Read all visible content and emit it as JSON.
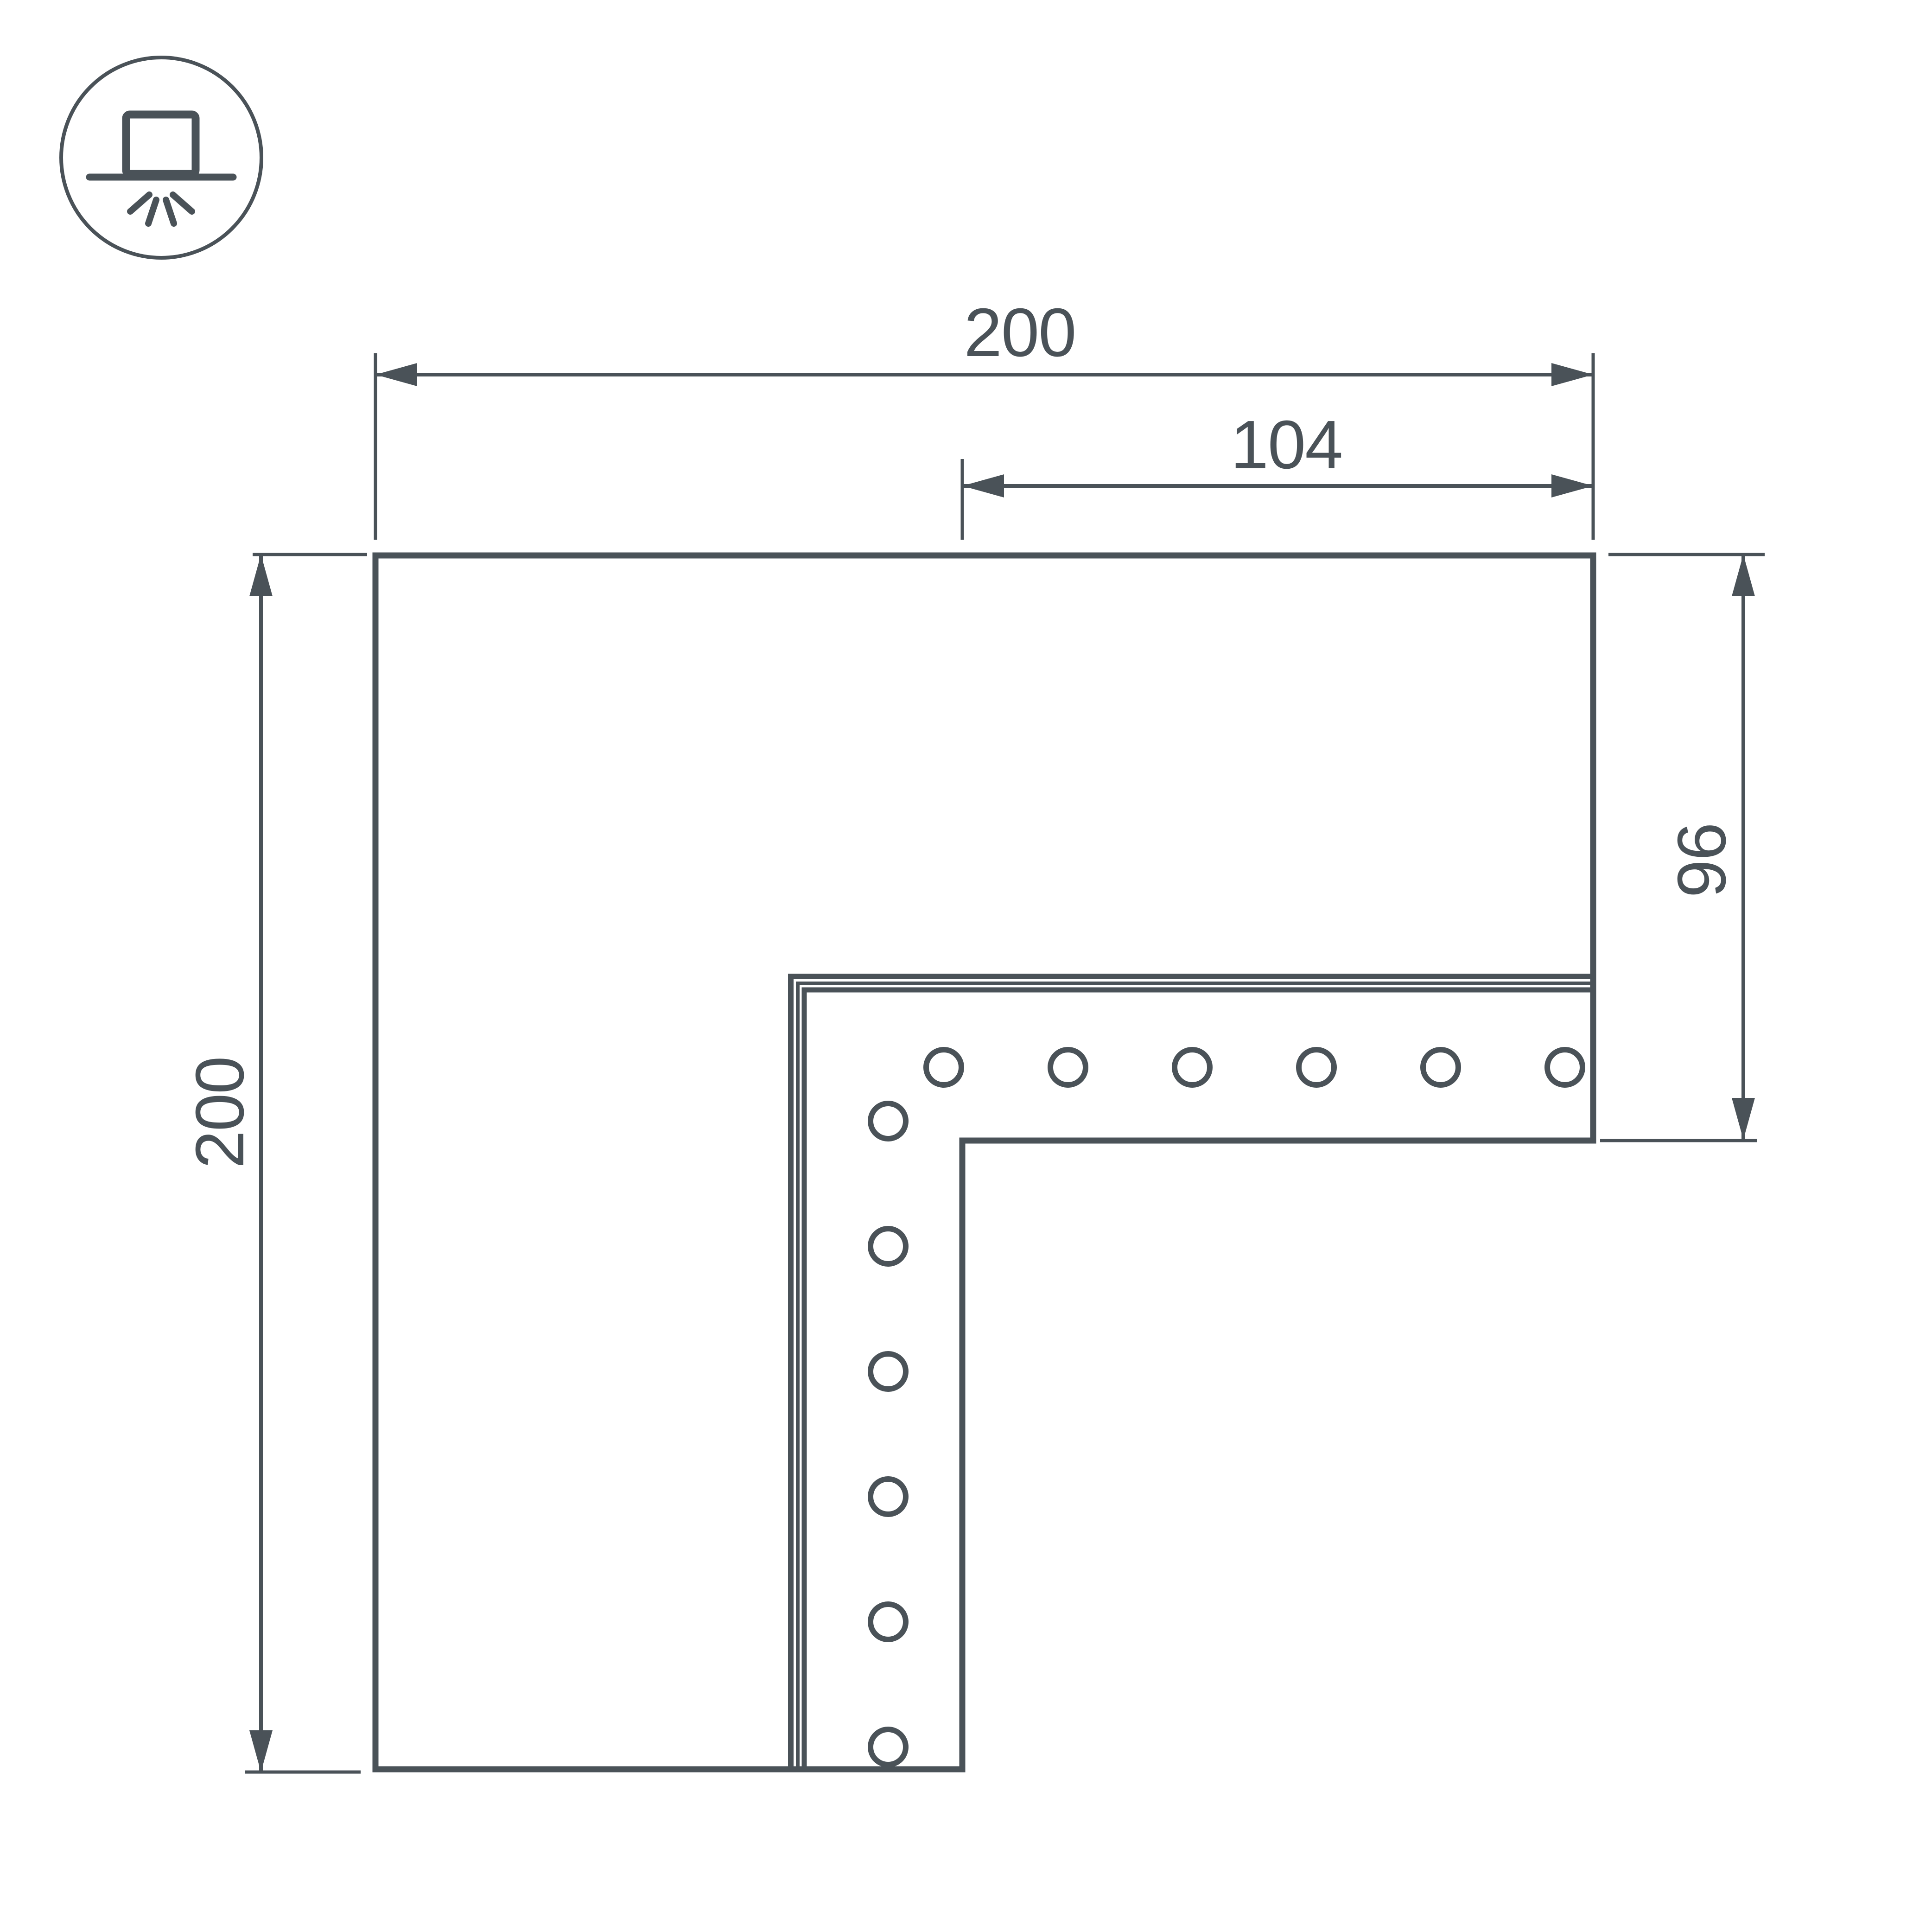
{
  "colors": {
    "line": "#4A5258",
    "background": "#ffffff"
  },
  "icon": {
    "name": "surface-mounted-light",
    "shape": "circle badge with box on line and four light rays below"
  },
  "dimensions": {
    "top_width": {
      "value": "200"
    },
    "inner_width": {
      "value": "104"
    },
    "left_height": {
      "value": "200"
    },
    "right_height": {
      "value": "96"
    }
  },
  "connector": {
    "holes_horizontal_row": 6,
    "holes_vertical_column": 6,
    "corner_hole": 1,
    "edge_line_count": 3
  }
}
